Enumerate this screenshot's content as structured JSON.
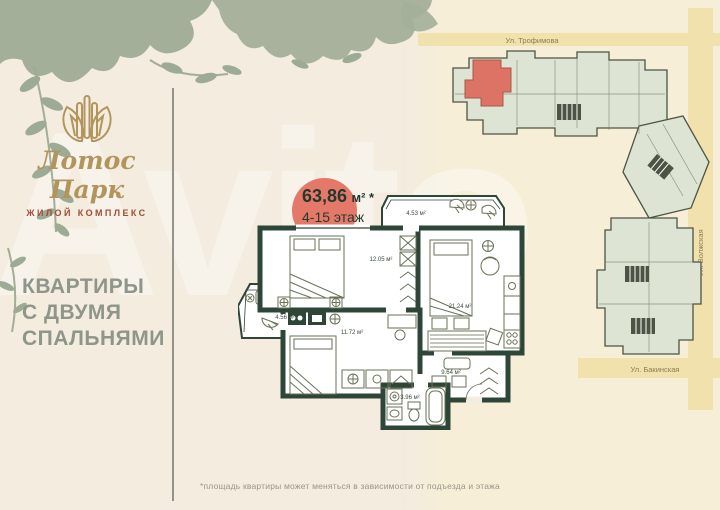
{
  "logo": {
    "title": "Лотос Парк",
    "subtitle": "жилой комплекс"
  },
  "left_panel": {
    "heading_lines": [
      "КВАРТИРЫ",
      "С ДВУМЯ",
      "СПАЛЬНЯМИ"
    ]
  },
  "apartment": {
    "area_value": "63,86",
    "area_unit": "м² *",
    "floors": "4-15 этаж",
    "rooms": {
      "balcony_top": {
        "label": "4.53 м²"
      },
      "bedroom_1": {
        "label": "12.05 м²"
      },
      "living": {
        "label": "21.24 м²"
      },
      "balcony_left": {
        "label": "4.56 м²"
      },
      "bedroom_2": {
        "label": "11.72 м²"
      },
      "hallway": {
        "label": "9.64 м²"
      },
      "bathroom": {
        "label": "3.96 м²"
      }
    }
  },
  "site_plan": {
    "streets": {
      "trofimova": {
        "name": "Ул. Трофимова"
      },
      "volzhskaya": {
        "name": "Ул. Волжская"
      },
      "bakinskaya": {
        "name": "Ул. Бакинская"
      }
    }
  },
  "footnote": "*площадь квартиры может меняться в зависимости от подъезда и этажа",
  "watermark": "Avito",
  "colors": {
    "background": "#f3ecdf",
    "accent_red": "#e4796a",
    "wall_green": "#2e4638",
    "logo_gold": "#b2955c",
    "subtitle_red": "#a04b38",
    "heading_gray": "#8e968b",
    "leaf_sage": "#a3af99",
    "street_band": "#f1e1ad",
    "building_fill": "#dde4d4"
  }
}
